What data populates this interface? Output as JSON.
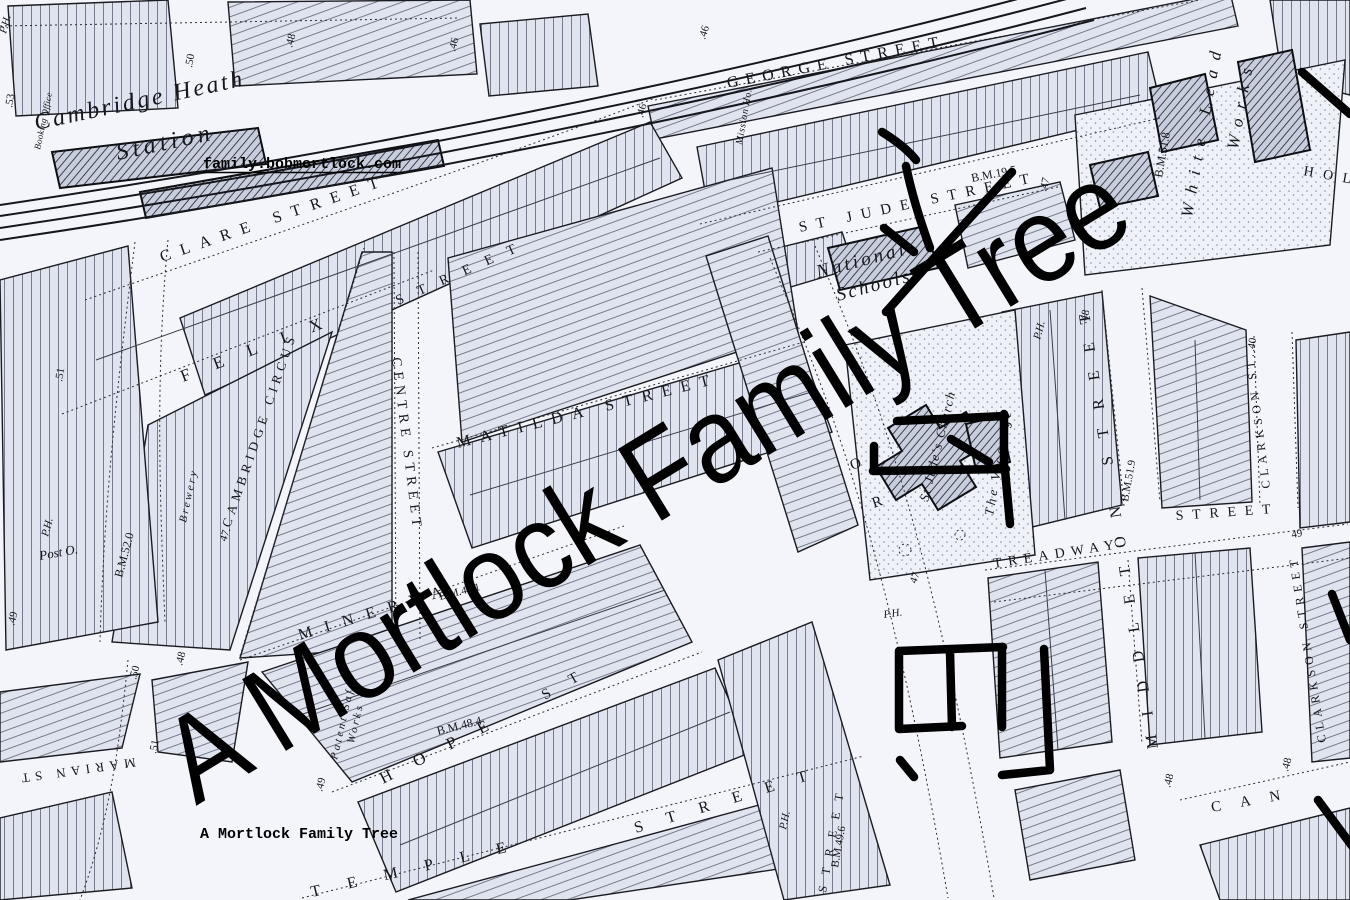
{
  "watermark": {
    "text": "A Mortlock Family Tree"
  },
  "site_credit": {
    "url_text": "family.bobmortlock.com",
    "caption": "A Mortlock Family Tree"
  },
  "colors": {
    "ink": "#15171c",
    "paper": "#f3f5fa",
    "watermark": "#000000"
  },
  "map": {
    "station": {
      "name_line1": "Cambridge Heath",
      "name_line2": "Station",
      "office": "Booking Office"
    },
    "streets": [
      {
        "name": "george-street",
        "text": "GEORGE STREET"
      },
      {
        "name": "st-jude-street",
        "text": "ST JUDE STREET"
      },
      {
        "name": "clare-street",
        "text": "CLARE STREET"
      },
      {
        "name": "felix-street",
        "text": "FELIX"
      },
      {
        "name": "ne-street",
        "text": "STREET"
      },
      {
        "name": "cambridge-circus",
        "text": "CAMBRIDGE CIRCUS"
      },
      {
        "name": "centre-street",
        "text": "CENTRE STREET"
      },
      {
        "name": "matilda-street",
        "text": "MATILDA STREET"
      },
      {
        "name": "minerva-street",
        "text": "MINERVA"
      },
      {
        "name": "hope-street",
        "text": "HOPE"
      },
      {
        "name": "hope-street-st",
        "text": "ST"
      },
      {
        "name": "temple-street",
        "text": "TEMPLE"
      },
      {
        "name": "temple-street-street",
        "text": "STREET"
      },
      {
        "name": "treadway-street",
        "text": "TREADWAY"
      },
      {
        "name": "treadway-street-street",
        "text": "STREET"
      },
      {
        "name": "middleton-street",
        "text": "MIDDLETON STREET"
      },
      {
        "name": "clarkson-st",
        "text": "CLARKSON ST."
      },
      {
        "name": "clarkson-street",
        "text": "CLARKSON STREET"
      },
      {
        "name": "marian-street",
        "text": "MARIAN ST"
      },
      {
        "name": "can-street",
        "text": "CAN"
      },
      {
        "name": "hol-street",
        "text": "HOL"
      },
      {
        "name": "road-letter-o",
        "text": "O"
      },
      {
        "name": "road-letter-r",
        "text": "R"
      },
      {
        "name": "street-south",
        "text": "STREET"
      }
    ],
    "places": [
      {
        "name": "national-schools-1",
        "text": "National"
      },
      {
        "name": "national-schools-2",
        "text": "Schools"
      },
      {
        "name": "st-judes-church",
        "text": "St Jude's Church"
      },
      {
        "name": "the-vicarage",
        "text": "The Vicarage"
      },
      {
        "name": "white-lead-works-1",
        "text": "White Lead"
      },
      {
        "name": "white-lead-works-2",
        "text": "Works"
      },
      {
        "name": "post-office",
        "text": "Post O."
      },
      {
        "name": "brewery",
        "text": "Brewery"
      },
      {
        "name": "patent-safe-works-1",
        "text": "Patent Safe"
      },
      {
        "name": "patent-safe-works-2",
        "text": "Works"
      },
      {
        "name": "mission-house",
        "text": "Mission Ho."
      },
      {
        "name": "public-house-1",
        "text": "P.H."
      },
      {
        "name": "public-house-2",
        "text": "P.H."
      },
      {
        "name": "public-house-3",
        "text": "P.H."
      },
      {
        "name": "public-house-4",
        "text": "P.H."
      },
      {
        "name": "public-house-5",
        "text": "P.H."
      }
    ],
    "benchmarks": [
      "B.M.19.5",
      "B.M.51.8",
      "B.M.51.9",
      "B.M.52.0",
      "B.M.48.4",
      "B.M.49.6",
      "B.M.48.1"
    ],
    "spot_heights": [
      ".53",
      ".50",
      ".48",
      ".46",
      ".46",
      ".46",
      ".51",
      "47.",
      ".48",
      ".50",
      ".51",
      ".49",
      "47",
      ".40",
      "49",
      ".48",
      ".48",
      ".47",
      ".48",
      ".49"
    ]
  }
}
